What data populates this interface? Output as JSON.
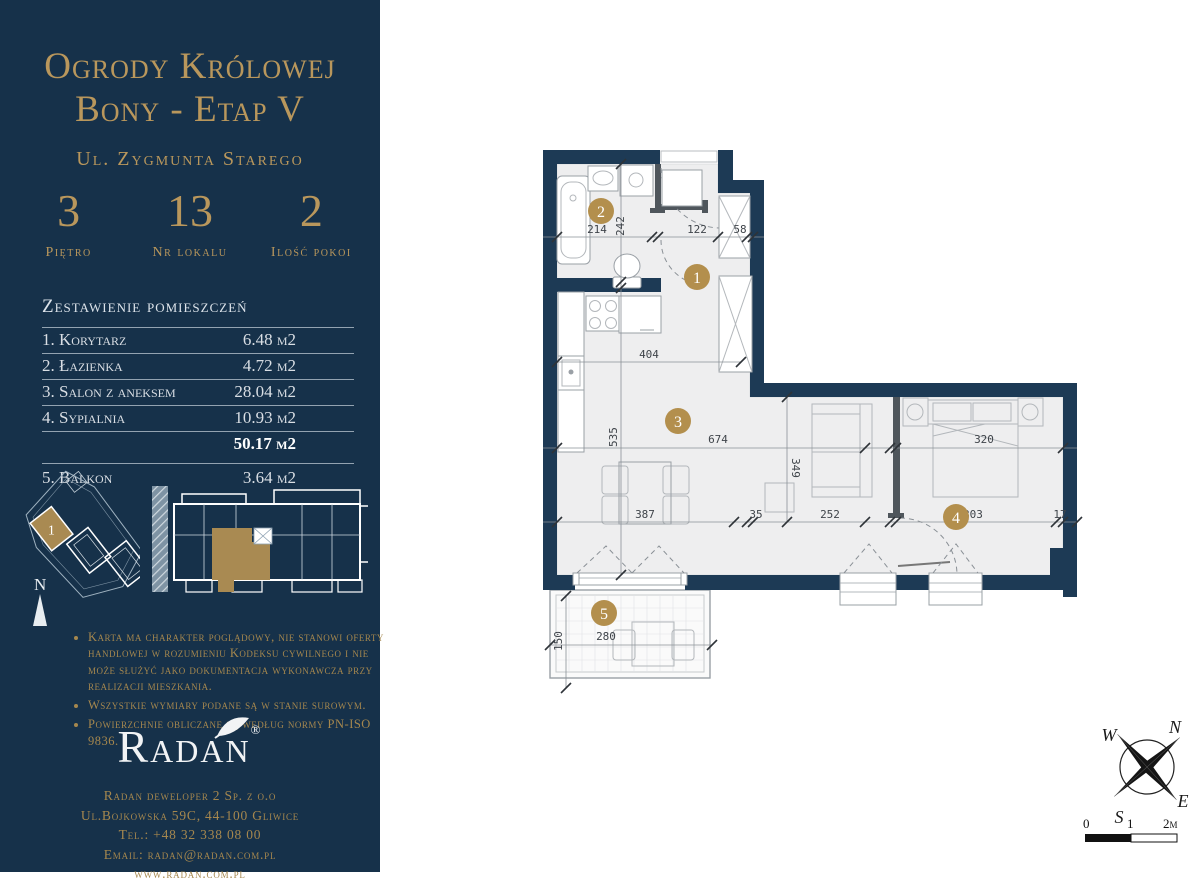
{
  "theme": {
    "navy": "#16314a",
    "wall": "#1d3a55",
    "gold": "#b9975c",
    "tan": "#b38f4d",
    "floor": "#eeeeef"
  },
  "sidebar": {
    "title_line1": "Ogrody Królowej",
    "title_line2": "Bony - Etap V",
    "address": "Ul. Zygmunta Starego",
    "stats": [
      {
        "value": "3",
        "label": "Piętro"
      },
      {
        "value": "13",
        "label": "Nr lokalu"
      },
      {
        "value": "2",
        "label": "Ilość pokoi"
      }
    ],
    "rooms_header": "Zestawienie pomieszczeń",
    "rooms": [
      {
        "name": "1. Korytarz",
        "area": "6.48 m2"
      },
      {
        "name": "2. Łazienka",
        "area": "4.72 m2"
      },
      {
        "name": "3. Salon z aneksem",
        "area": "28.04 m2"
      },
      {
        "name": "4. Sypialnia",
        "area": "10.93 m2"
      }
    ],
    "total_area": "50.17 m2",
    "balcony": {
      "name": "5. Balkon",
      "area": "3.64 m2"
    },
    "site_unit_label": "1",
    "north_label": "N",
    "notes": [
      "Karta ma charakter poglądowy, nie stanowi oferty handlowej w rozumieniu Kodeksu cywilnego i nie może służyć jako dokumentacja wykonawcza przy realizacji mieszkania.",
      "Wszystkie wymiary podane są w stanie surowym.",
      "Powierzchnie obliczane są według normy PN-ISO 9836."
    ],
    "logo_text": "Radan",
    "logo_reg": "®",
    "footer_lines": [
      "Radan deweloper 2 Sp. z o.o",
      "Ul.Bojkowska 59C, 44-100 Gliwice",
      "Tel.: +48 32 338 08 00",
      "Email: radan@radan.com.pl",
      "www.radan.com.pl"
    ]
  },
  "plan": {
    "badges": [
      "1",
      "2",
      "3",
      "4",
      "5"
    ],
    "dims": {
      "d214": "214",
      "d242": "242",
      "d122": "122",
      "d58": "58",
      "d404": "404",
      "d535": "535",
      "d674": "674",
      "d320": "320",
      "d349": "349",
      "d387": "387",
      "d35": "35",
      "d252": "252",
      "d303": "303",
      "d17": "17",
      "d150": "150",
      "d280": "280"
    }
  },
  "compass": {
    "n": "N",
    "e": "E",
    "s": "S",
    "w": "W"
  },
  "scalebar": {
    "zero": "0",
    "one": "1",
    "two": "2m"
  }
}
